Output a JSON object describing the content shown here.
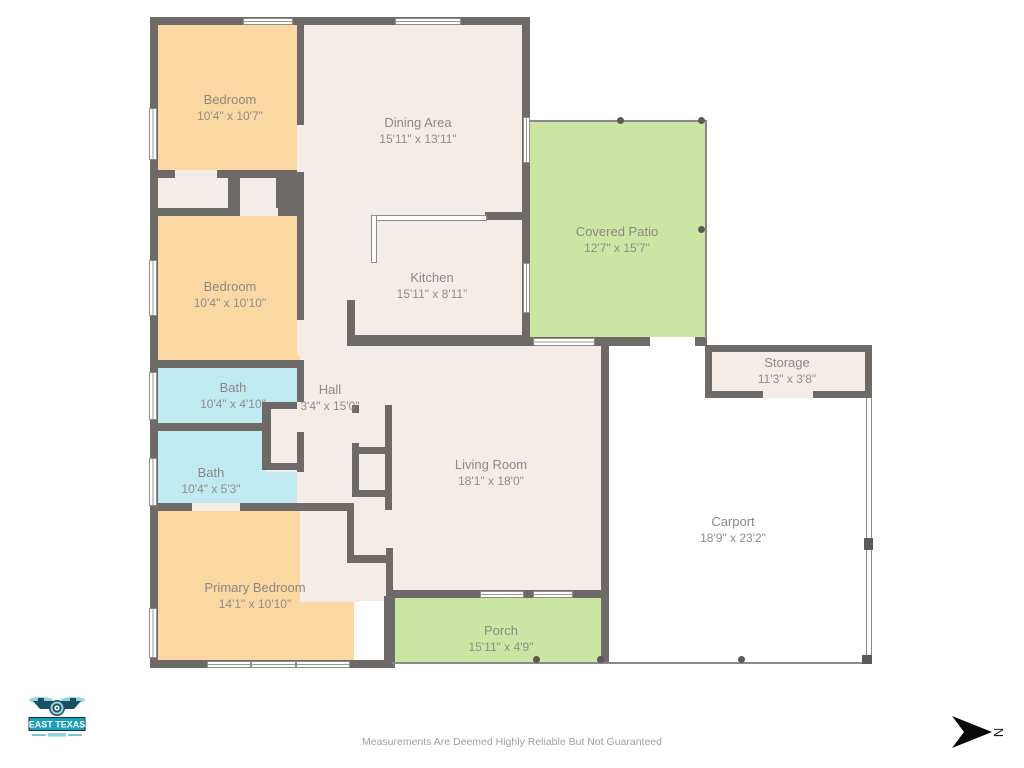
{
  "title": "Floor Plan",
  "rooms": {
    "bedroom1": {
      "name": "Bedroom",
      "dims": "10'4\" x 10'7\""
    },
    "dining": {
      "name": "Dining Area",
      "dims": "15'11\" x 13'11\""
    },
    "patio": {
      "name": "Covered Patio",
      "dims": "12'7\" x 15'7\""
    },
    "bedroom2": {
      "name": "Bedroom",
      "dims": "10'4\" x 10'10\""
    },
    "kitchen": {
      "name": "Kitchen",
      "dims": "15'11\" x 8'11\""
    },
    "bath1": {
      "name": "Bath",
      "dims": "10'4\" x 4'10\""
    },
    "hall": {
      "name": "Hall",
      "dims": "3'4\" x 15'0\""
    },
    "storage": {
      "name": "Storage",
      "dims": "11'3\" x 3'8\""
    },
    "bath2": {
      "name": "Bath",
      "dims": "10'4\" x 5'3\""
    },
    "living": {
      "name": "Living Room",
      "dims": "18'1\" x 18'0\""
    },
    "carport": {
      "name": "Carport",
      "dims": "18'9\" x 23'2\""
    },
    "primary": {
      "name": "Primary Bedroom",
      "dims": "14'1\" x 10'10\""
    },
    "porch": {
      "name": "Porch",
      "dims": "15'11\" x 4'9\""
    }
  },
  "footer": {
    "disclaimer": "Measurements Are Deemed Highly Reliable But Not Guaranteed"
  },
  "logo": {
    "title": "EAST TEXAS"
  },
  "compass": {
    "label": "N"
  },
  "colors": {
    "wall": "#6d6a67",
    "floor": "#f4ede7",
    "bedroom_fill": "#fbd7a2",
    "bath_fill": "#c0eaf2",
    "outdoor_fill": "#cbe6a3",
    "logo_teal": "#1b9fb8"
  }
}
